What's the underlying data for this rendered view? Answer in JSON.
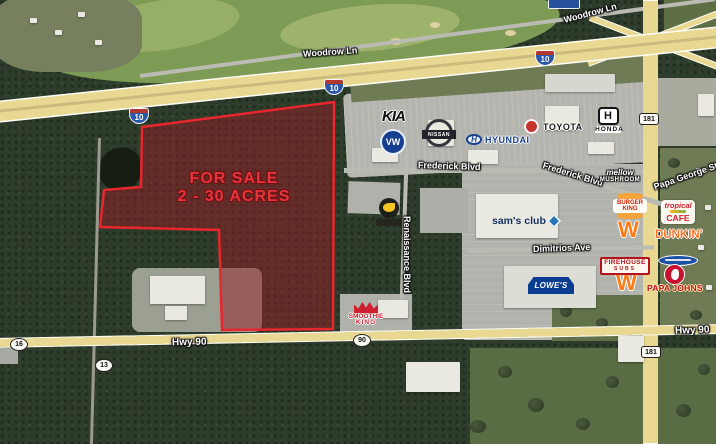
{
  "parcel": {
    "line1": "FOR SALE",
    "line2": "2 - 30 ACRES",
    "outline_color": "#e8262d",
    "fill_color": "rgba(150,28,38,0.5)"
  },
  "roads": {
    "woodrow_nw": "Woodrow Ln",
    "woodrow_ne": "Woodrow Ln",
    "frederick_w": "Frederick Blvd",
    "frederick_e": "Frederick Blvd",
    "papa_george": "Papa George St",
    "dimitrios": "Dimitrios Ave",
    "renaissance": "Renaissance Blvd",
    "hwy90_w": "Hwy 90",
    "hwy90_e": "Hwy 90"
  },
  "shields": {
    "interstate_10": "10",
    "state_16": "16",
    "state_13": "13",
    "us_90": "90",
    "state_181": "181"
  },
  "logos": {
    "kia": "KIA",
    "vw": "VW",
    "nissan": "NISSAN",
    "hyundai_emblem": "H",
    "hyundai": "HYUNDAI",
    "toyota": "TOYOTA",
    "honda_emblem": "H",
    "honda": "HONDA",
    "sams_club": "sam's club",
    "lowes": "LOWE'S",
    "burger_king_line1": "BURGER",
    "burger_king_line2": "KING",
    "whataburger": "W",
    "tropical_line1": "tropical",
    "tropical_line2": "CAFE",
    "dunkin": "DUNKIN'",
    "firehouse_line1": "FIREHOUSE",
    "firehouse_line2": "SUBS",
    "papa_johns": "PAPA JOHNS",
    "mellow_line1": "mellow",
    "mellow_line2": "MUSHROOM",
    "smoothie_line1": "SMOOTHIE",
    "smoothie_line2": "KING"
  }
}
